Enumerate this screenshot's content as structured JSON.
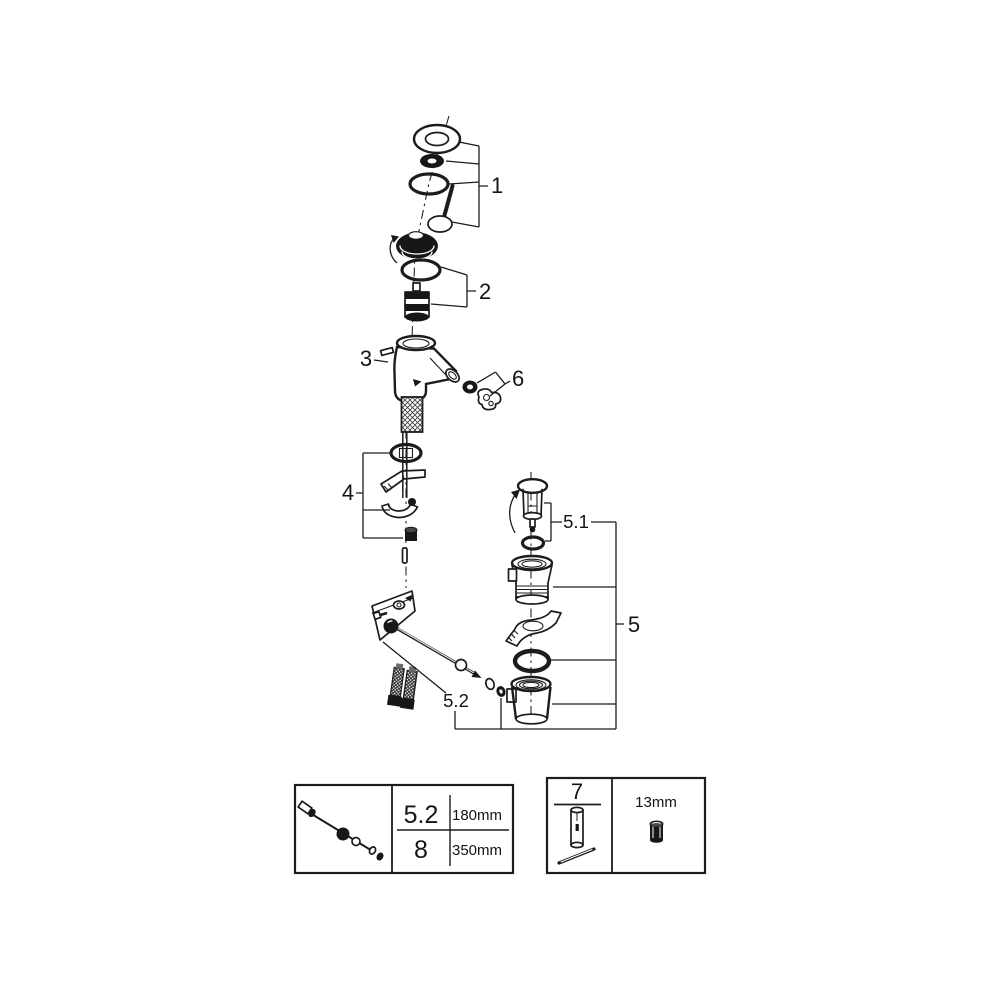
{
  "diagram": {
    "callouts": {
      "n1": "1",
      "n2": "2",
      "n3": "3",
      "n4": "4",
      "n5": "5",
      "n6": "6",
      "n51": "5.1",
      "n52": "5.2"
    },
    "length_table": {
      "rows": [
        {
          "ref": "5.2",
          "value": "180mm"
        },
        {
          "ref": "8",
          "value": "350mm"
        }
      ]
    },
    "tool_table": {
      "ref": "7",
      "size": "13mm"
    },
    "colors": {
      "line": "#1c1c1c",
      "background": "#ffffff"
    }
  }
}
